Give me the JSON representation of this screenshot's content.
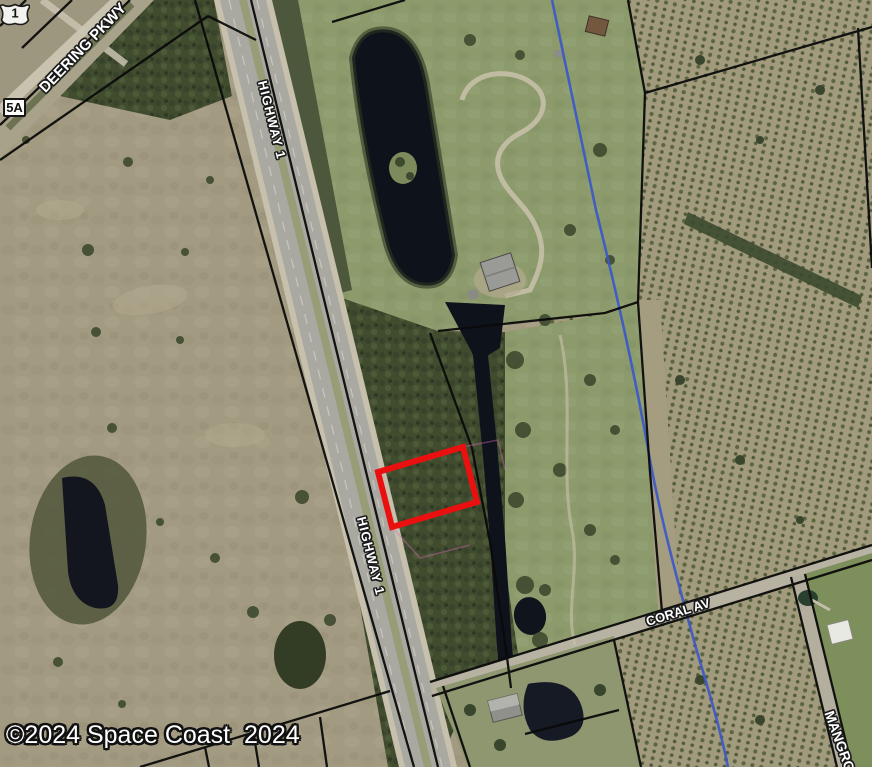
{
  "map": {
    "type": "aerial-parcel-map",
    "copyright": "©2024 Space Coast  2024",
    "labels": {
      "deering_pkwy": "DEERING PKWY",
      "highway_1_top": "HIGHWAY 1",
      "highway_1_mid": "HIGHWAY 1",
      "coral_av": "CORAL AV",
      "mangrove": "MANGROVE",
      "route_shield": "1",
      "exit_badge": "5A"
    },
    "colors": {
      "selected_parcel_outline": "#ea1010",
      "stream_line": "#3c58c8",
      "parcel_boundary": "#0b0b0b",
      "label_text": "#ffffff",
      "label_halo": "#1a1a1a"
    }
  }
}
